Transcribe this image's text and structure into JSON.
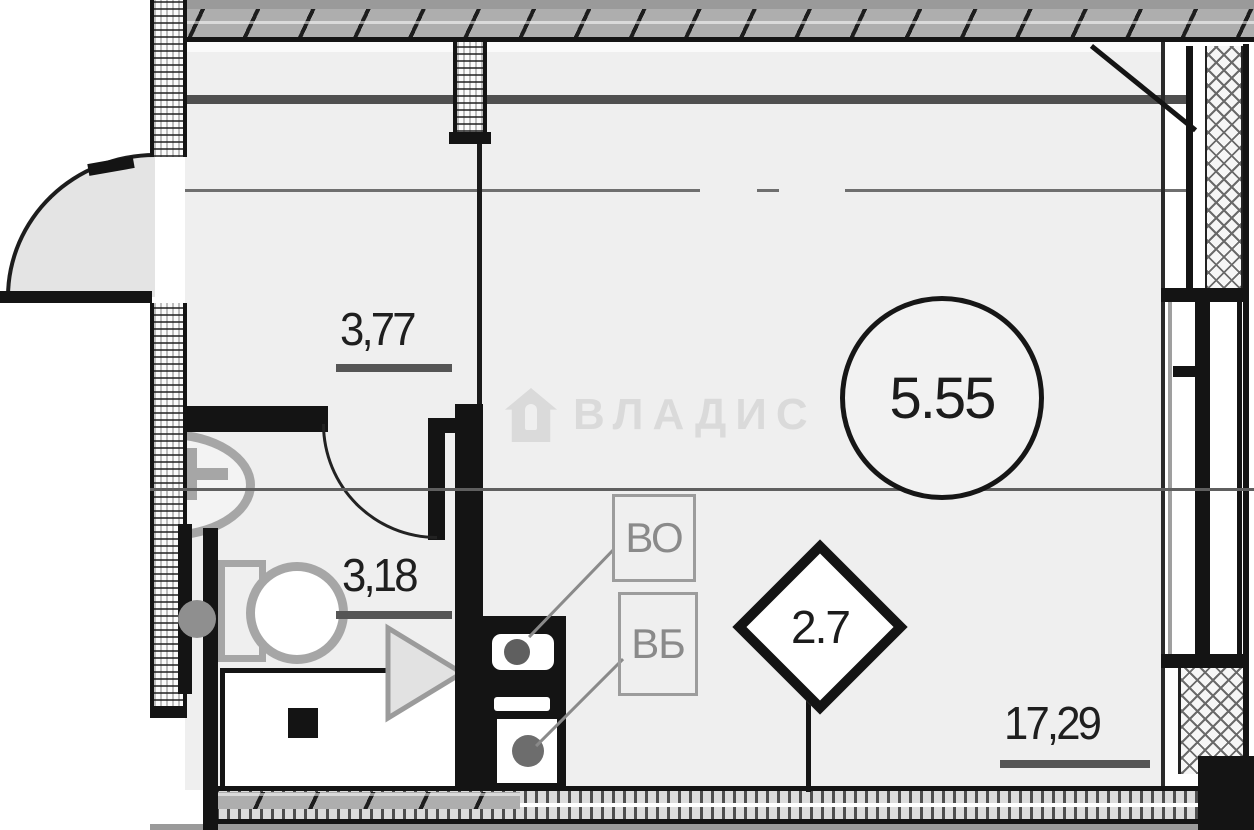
{
  "plan": {
    "watermark": {
      "text": "ВЛАДИС"
    },
    "rooms": [
      {
        "id": "hallway",
        "area": "3,77"
      },
      {
        "id": "bathroom",
        "area": "3,18"
      },
      {
        "id": "living-room",
        "area": "17,29"
      }
    ],
    "badges": {
      "circle_value": "5.55",
      "diamond_value": "2.7"
    },
    "shafts": [
      {
        "label": "ВО"
      },
      {
        "label": "ВБ"
      }
    ],
    "colors": {
      "wall": "#141414",
      "floor": "#efefef",
      "fixture_gray": "#a6a6a6",
      "annotation_gray": "#8a8a8a"
    }
  }
}
